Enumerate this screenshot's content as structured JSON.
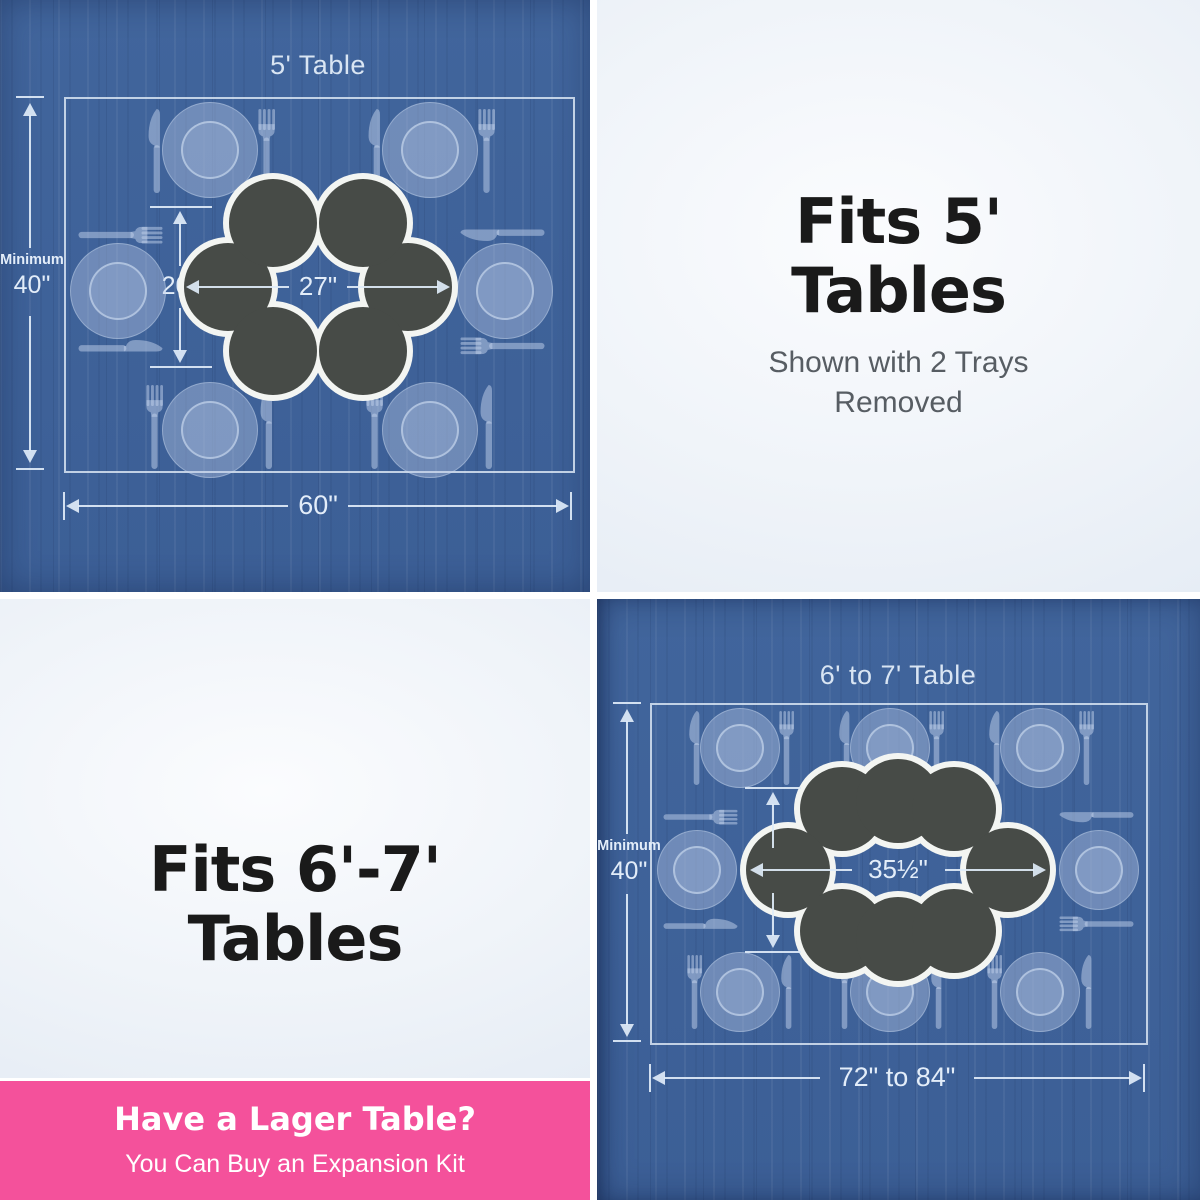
{
  "five_table_panel": {
    "title": "5' Table",
    "minimum_label": "Minimum",
    "minimum_value": "40\"",
    "ring_height": "20\"",
    "ring_width": "27\"",
    "table_width": "60\"",
    "tray_count": 6,
    "place_setting_count": 6
  },
  "fits_5_panel": {
    "heading_line1": "Fits 5'",
    "heading_line2": "Tables",
    "subtext_line1": "Shown with 2 Trays",
    "subtext_line2": "Removed"
  },
  "fits_67_panel": {
    "heading_line1": "Fits 6'-7'",
    "heading_line2": "Tables"
  },
  "six_seven_table_panel": {
    "title": "6' to 7' Table",
    "minimum_label": "Minimum",
    "minimum_value": "40\"",
    "ring_height": "20\"",
    "ring_width": "35½\"",
    "table_width": "72\" to 84\"",
    "tray_count": 8,
    "place_setting_count": 8
  },
  "expansion_banner": {
    "heading": "Have a Lager Table?",
    "subtext": "You Can Buy an Expansion Kit"
  },
  "colors": {
    "wood_blue": "#3e6299",
    "banner_pink": "#f4519b",
    "tray_charcoal": "#474b47",
    "blueprint_line": "#e0eaf7",
    "heading_black": "#1a1a1a",
    "subtext_gray": "#575d63"
  }
}
